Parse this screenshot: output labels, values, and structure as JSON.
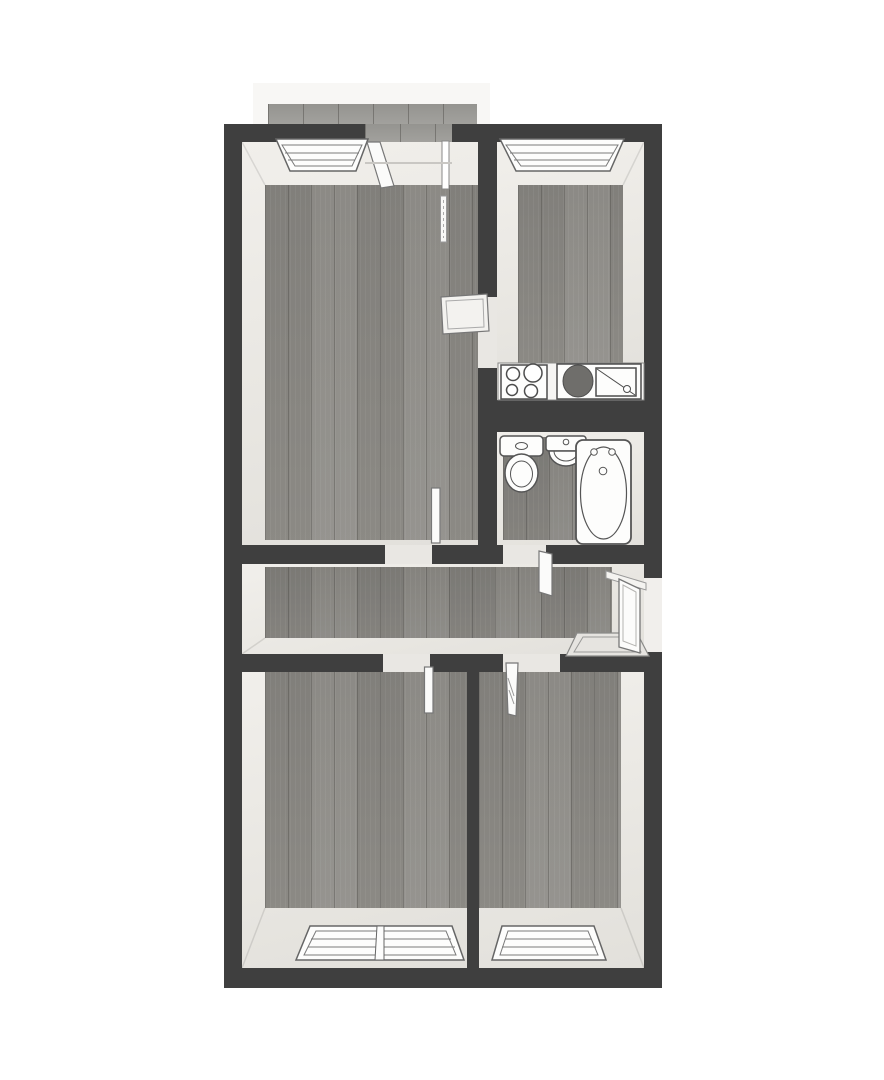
{
  "app": {
    "type": "floor-plan-viewer",
    "description": "Top-down 3D dollhouse render of a two-bedroom apartment floor plan with balcony; no text labels visible"
  },
  "palette": {
    "wall": "#3f3f3f",
    "interior_face": "#eceae6",
    "floor_wood": "#8f8d88",
    "floor_seam": "#5c5a56",
    "balcony_tile": "#9e9d99",
    "fixture_white": "#fbfbfa",
    "fixture_stroke": "#5a5a5a",
    "doormat": "#e6e4e0",
    "page_background": "#ffffff"
  },
  "rooms": [
    {
      "id": "living-room",
      "label": "Living room, top left, with window, balcony door, doors to hallway and kitchen"
    },
    {
      "id": "kitchen",
      "label": "Kitchen, top right, with window, cooktop and sink counter"
    },
    {
      "id": "bathroom",
      "label": "Bathroom, middle right, with toilet, washbasin and bathtub"
    },
    {
      "id": "hallway",
      "label": "Hallway, middle, with entrance door and doormat"
    },
    {
      "id": "bedroom-left",
      "label": "Bedroom, bottom left, with double window"
    },
    {
      "id": "bedroom-right",
      "label": "Bedroom, bottom right, with single window"
    },
    {
      "id": "balcony",
      "label": "Balcony, top outside, tiled floor"
    }
  ],
  "fixtures": {
    "cooktop": "4-burner cooktop",
    "kitchen_sink": "kitchen sink unit with basin and drainboard",
    "toilet": "toilet with cistern",
    "washbasin": "washbasin",
    "bathtub": "bathtub with faucet",
    "doormat": "doormat at entrance",
    "entrance_door": "entrance door, open",
    "balcony_door": "balcony door, open",
    "interior_door": "interior door, open"
  },
  "windows": {
    "living_room": "single window",
    "kitchen": "single window",
    "bedroom_left": "double window",
    "bedroom_right": "single window"
  }
}
